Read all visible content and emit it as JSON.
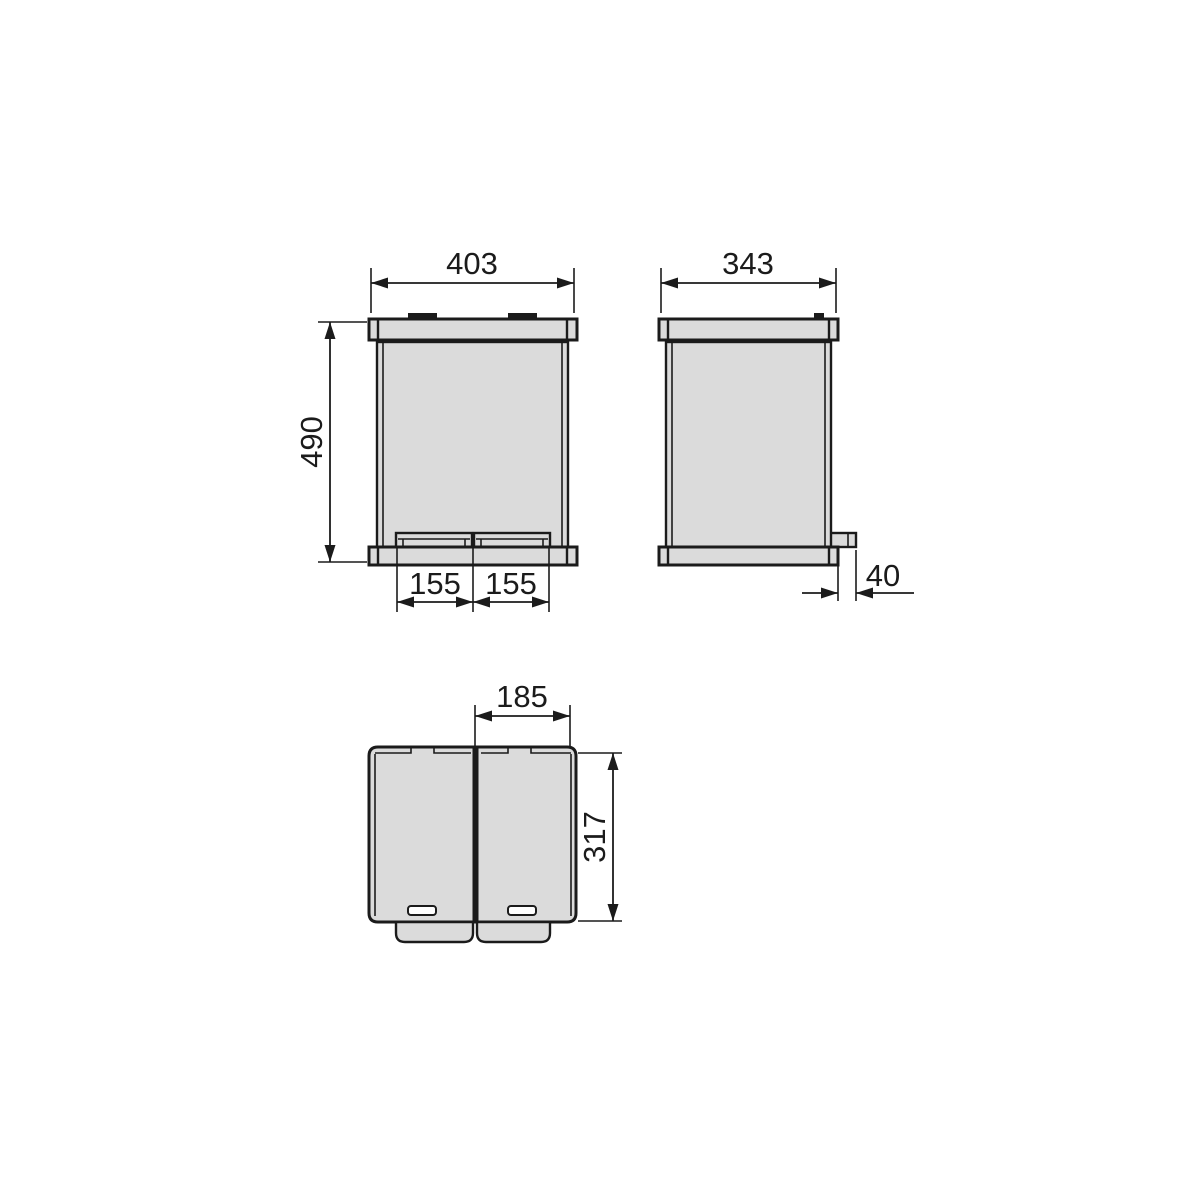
{
  "colors": {
    "background": "#ffffff",
    "shape_fill": "#dbdbdb",
    "line": "#1b1b1b",
    "tab_fill": "#1b1b1b",
    "slot_fill": "#ffffff"
  },
  "drawing": {
    "dimensions": {
      "front_width": "403",
      "front_height": "490",
      "front_pedal_left": "155",
      "front_pedal_right": "155",
      "side_depth": "343",
      "side_pedal_protrusion": "40",
      "top_lid_width": "185",
      "top_depth": "317"
    }
  }
}
